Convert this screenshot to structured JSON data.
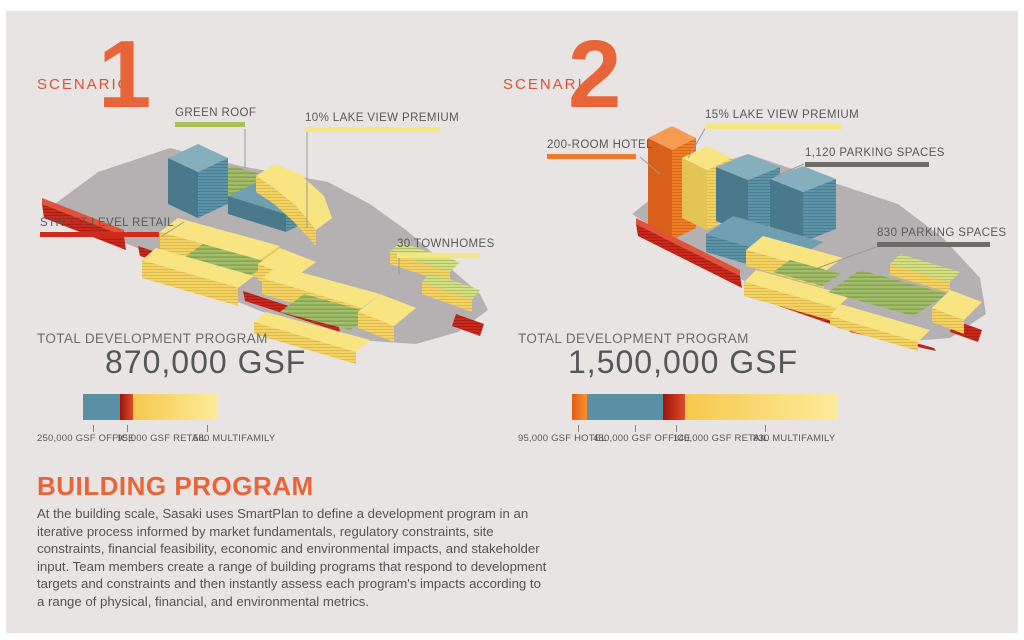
{
  "palette": {
    "accent_orange": "#e8653a",
    "teal": "#5b8fa3",
    "red": "#cf2a1e",
    "yellow": "#f6e67e",
    "green": "#a8c258",
    "parking_gray": "#6f6b69",
    "hotel_orange": "#ee7a2a"
  },
  "scenarios": [
    {
      "label": "SCENARIO",
      "number": "1",
      "callouts": {
        "green_roof": {
          "text": "GREEN ROOF",
          "color": "#a8c258"
        },
        "lake_view": {
          "text": "10% LAKE VIEW PREMIUM",
          "color": "#f6e67e"
        },
        "street_retail": {
          "text": "STREET LEVEL RETAIL",
          "color": "#cf2a1e"
        },
        "townhomes": {
          "text": "30 TOWNHOMES",
          "color": "#f6e67e"
        }
      },
      "total_label": "TOTAL DEVELOPMENT PROGRAM",
      "total_value": "870,000 GSF",
      "bar_segments": [
        {
          "label": "250,000 GSF OFFICE",
          "width": "37px",
          "background": "#5b8fa3"
        },
        {
          "label": "95,000 GSF RETAIL",
          "width": "13px",
          "background": "linear-gradient(90deg,#9c150c,#e04b28)"
        },
        {
          "label": "580 MULTIFAMILY",
          "width": "85px",
          "background": "linear-gradient(90deg,#f6c94e,#fdeb9c)"
        }
      ]
    },
    {
      "label": "SCENARIO",
      "number": "2",
      "callouts": {
        "hotel": {
          "text": "200-ROOM HOTEL",
          "color": "#ee7a2a"
        },
        "lake_view": {
          "text": "15% LAKE VIEW PREMIUM",
          "color": "#f6e67e"
        },
        "parking_1120": {
          "text": "1,120 PARKING SPACES",
          "color": "#6f6b69"
        },
        "parking_830": {
          "text": "830 PARKING SPACES",
          "color": "#6f6b69"
        }
      },
      "total_label": "TOTAL DEVELOPMENT PROGRAM",
      "total_value": "1,500,000 GSF",
      "bar_segments": [
        {
          "label": "95,000 GSF HOTEL",
          "width": "15px",
          "background": "linear-gradient(90deg,#e35c13,#f5912f)"
        },
        {
          "label": "480,000 GSF OFFICE",
          "width": "76px",
          "background": "#5b8fa3"
        },
        {
          "label": "140,000 GSF RETAIL",
          "width": "22px",
          "background": "linear-gradient(90deg,#9c150c,#e04b28)"
        },
        {
          "label": "830 MULTIFAMILY",
          "width": "153px",
          "background": "linear-gradient(90deg,#f6c94e,#fdeb9c)"
        }
      ]
    }
  ],
  "footer": {
    "heading": "BUILDING PROGRAM",
    "body": "At the building scale, Sasaki uses SmartPlan to define a development program in an iterative process informed by market fundamentals, regulatory constraints, site constraints, financial feasibility, economic and environmental impacts, and stakeholder input. Team members create a range of building programs that respond to development targets and constraints and then instantly assess each program's impacts according to a range of physical, financial, and environmental metrics."
  }
}
